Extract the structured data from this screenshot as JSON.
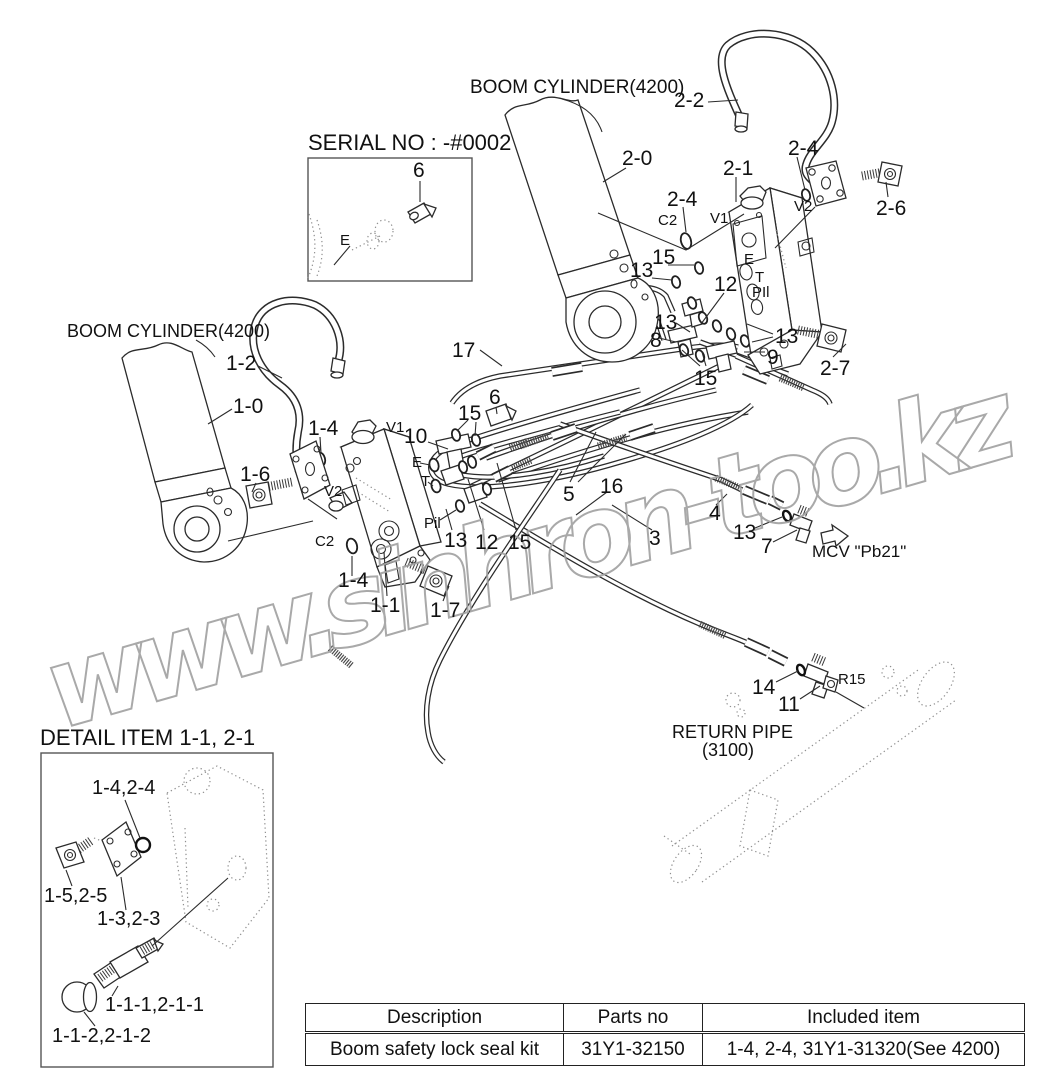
{
  "labels": {
    "boom_cylinder_top": "BOOM CYLINDER(4200)",
    "boom_cylinder_left": "BOOM CYLINDER(4200)",
    "serial_no": "SERIAL NO : -#0002",
    "detail_title": "DETAIL ITEM 1-1, 2-1",
    "mcv": "MCV \"Pb21\"",
    "return_pipe_line1": "RETURN PIPE",
    "return_pipe_line2": "(3100)",
    "watermark": "www.sinhron-too.kz"
  },
  "callouts": [
    {
      "text": "2-2"
    },
    {
      "text": "2-0"
    },
    {
      "text": "2-1"
    },
    {
      "text": "2-4"
    },
    {
      "text": "2-6"
    },
    {
      "text": "V2"
    },
    {
      "text": "2-4"
    },
    {
      "text": "C2"
    },
    {
      "text": "V1"
    },
    {
      "text": "15"
    },
    {
      "text": "13"
    },
    {
      "text": "12"
    },
    {
      "text": "E"
    },
    {
      "text": "T"
    },
    {
      "text": "PIl"
    },
    {
      "text": "13"
    },
    {
      "text": "8"
    },
    {
      "text": "13"
    },
    {
      "text": "9"
    },
    {
      "text": "15"
    },
    {
      "text": "2-7"
    },
    {
      "text": "17"
    },
    {
      "text": "1-2"
    },
    {
      "text": "1-0"
    },
    {
      "text": "1-4"
    },
    {
      "text": "1-6"
    },
    {
      "text": "V2"
    },
    {
      "text": "V1"
    },
    {
      "text": "10"
    },
    {
      "text": "6"
    },
    {
      "text": "15"
    },
    {
      "text": "E"
    },
    {
      "text": "T"
    },
    {
      "text": "Pil"
    },
    {
      "text": "C2"
    },
    {
      "text": "1-4"
    },
    {
      "text": "1-1"
    },
    {
      "text": "1-7"
    },
    {
      "text": "13"
    },
    {
      "text": "12"
    },
    {
      "text": "15"
    },
    {
      "text": "5"
    },
    {
      "text": "16"
    },
    {
      "text": "3"
    },
    {
      "text": "4"
    },
    {
      "text": "13"
    },
    {
      "text": "7"
    },
    {
      "text": "14"
    },
    {
      "text": "11"
    },
    {
      "text": "R15"
    },
    {
      "text": "6"
    },
    {
      "text": "E"
    }
  ],
  "detail_callouts": [
    {
      "text": "1-4,2-4"
    },
    {
      "text": "1-5,2-5"
    },
    {
      "text": "1-3,2-3"
    },
    {
      "text": "1-1-1,2-1-1"
    },
    {
      "text": "1-1-2,2-1-2"
    }
  ],
  "table": {
    "headers": [
      "Description",
      "Parts no",
      "Included item"
    ],
    "rows": [
      [
        "Boom safety lock seal kit",
        "31Y1-32150",
        "1-4, 2-4, 31Y1-31320(See 4200)"
      ]
    ]
  },
  "colors": {
    "line": "#2b2b2b",
    "watermark": "#a0a0a0",
    "background": "#ffffff"
  }
}
